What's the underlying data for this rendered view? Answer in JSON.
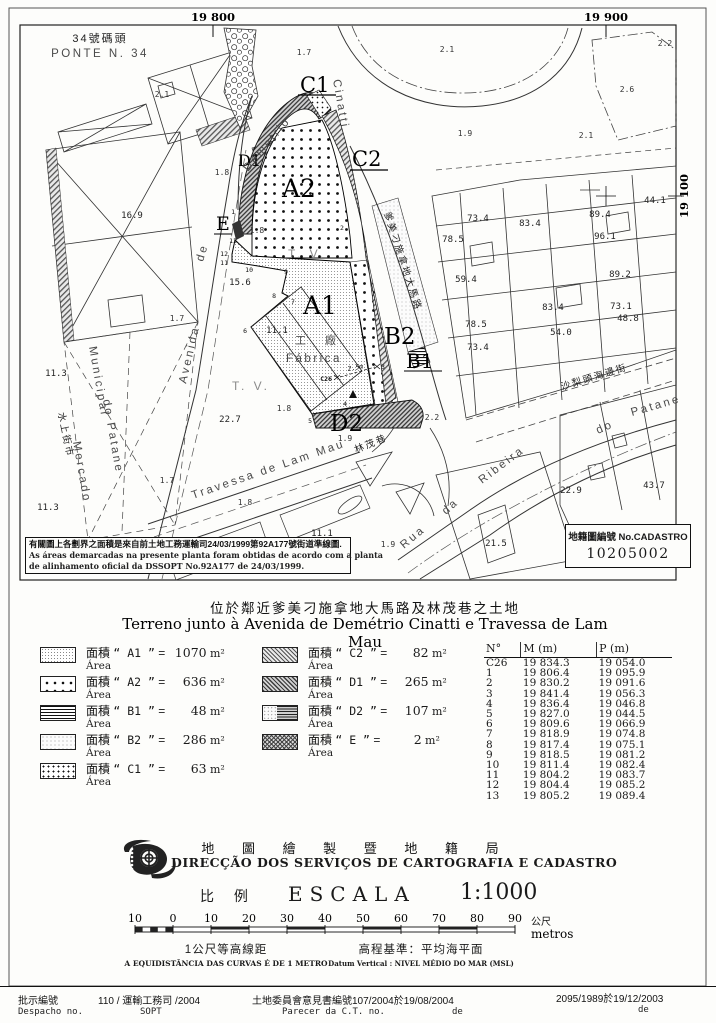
{
  "map": {
    "grid": {
      "top_left": "19 800",
      "top_right": "19 900",
      "right": "19 100"
    },
    "pier_zh": "34號碼頭",
    "pier_pt": "PONTE N. 34",
    "area_labels": {
      "a1": "A1",
      "a2": "A2",
      "b1": "B1",
      "b2": "B2",
      "c1": "C1",
      "c2": "C2",
      "d1": "D1",
      "d2": "D2",
      "e": "E"
    },
    "factory_zh": "工 廠",
    "factory_pt": "Fábrica",
    "tv1": "T. V.",
    "tv2": "T. V.",
    "streets": {
      "avenida": "Avenida",
      "de": "de",
      "demetrio": "Demetrio",
      "cinatti": "Cinatti",
      "cinatti_zh": "爹美刁施拿地大馬路",
      "travessa": "Travessa de Lam Mau",
      "travessa_zh": "林茂巷",
      "rua": "Rua",
      "da": "da",
      "ribeira": "Ribeira",
      "do": "do",
      "patane": "Patane",
      "beira_mar_zh": "沙梨頭海邊街",
      "mercado_zh": "水上街市",
      "mercado_1": "Mercado",
      "mercado_2": "Municipal",
      "mercado_3": "do Patane"
    },
    "point_c26": "C26",
    "c26_note": "2.5m",
    "points": [
      "1",
      "2",
      "3",
      "4",
      "5",
      "6",
      "7",
      "8",
      "9",
      "10",
      "11",
      "12",
      "13"
    ],
    "heights": [
      "73.4",
      "83.4",
      "89.4",
      "96.1",
      "78.5",
      "59.4",
      "89.2",
      "83.4",
      "73.1",
      "48.8",
      "78.5",
      "54.0",
      "73.4",
      "44.1",
      "43.7",
      "22.9",
      "21.5",
      "22.7",
      "11.1",
      "11.1",
      "15.6",
      "16.9",
      "11.3",
      "11.3"
    ],
    "spots": [
      "2.1",
      "1.7",
      "2.1",
      "2.2",
      "2.6",
      "1.9",
      "2.1",
      "1.8",
      "1.8",
      "1.7",
      "1.7",
      "1.8",
      "1.9",
      "2.2",
      "1.8",
      "1.9"
    ],
    "note_zh": "有關圖上各劃界之面積是來自前土地工務運輸司24/03/1999第92A177號街道準線圖.",
    "note_pt_1": "As áreas demarcadas na presente planta foram obtidas de acordo com a planta",
    "note_pt_2": "de alinhamento oficial da DSSOPT No.92A177 de 24/03/1999.",
    "cadastro_label": "地籍圖編號 No.CADASTRO",
    "cadastro_no": "10205002"
  },
  "title": {
    "zh": "位於鄰近爹美刁施拿地大馬路及林茂巷之土地",
    "pt": "Terreno junto à Avenida de Demétrio Cinatti e Travessa de Lam Mau"
  },
  "legend": {
    "area_zh": "面積",
    "area_pt": "Área",
    "eq": "=",
    "items": [
      {
        "code_disp": "“ A1 ”",
        "value": "1070",
        "unit": "m²"
      },
      {
        "code_disp": "“ A2 ”",
        "value": "636",
        "unit": "m²"
      },
      {
        "code_disp": "“ B1 ”",
        "value": "48",
        "unit": "m²"
      },
      {
        "code_disp": "“ B2 ”",
        "value": "286",
        "unit": "m²"
      },
      {
        "code_disp": "“ C1 ”",
        "value": "63",
        "unit": "m²"
      },
      {
        "code_disp": "“ C2 ”",
        "value": "82",
        "unit": "m²"
      },
      {
        "code_disp": "“ D1 ”",
        "value": "265",
        "unit": "m²"
      },
      {
        "code_disp": "“ D2 ”",
        "value": "107",
        "unit": "m²"
      },
      {
        "code_disp": "“ E ”",
        "value": "2",
        "unit": "m²"
      }
    ]
  },
  "table": {
    "headers": [
      "N°",
      "M (m)",
      "P (m)"
    ],
    "rows": [
      [
        "C26",
        "19 834.3",
        "19 054.0"
      ],
      [
        "1",
        "19 806.4",
        "19 095.9"
      ],
      [
        "2",
        "19 830.2",
        "19 091.6"
      ],
      [
        "3",
        "19 841.4",
        "19 056.3"
      ],
      [
        "4",
        "19 836.4",
        "19 046.8"
      ],
      [
        "5",
        "19 827.0",
        "19 044.5"
      ],
      [
        "6",
        "19 809.6",
        "19 066.9"
      ],
      [
        "7",
        "19 818.9",
        "19 074.8"
      ],
      [
        "8",
        "19 817.4",
        "19 075.1"
      ],
      [
        "9",
        "19 818.5",
        "19 081.2"
      ],
      [
        "10",
        "19 811.4",
        "19 082.4"
      ],
      [
        "11",
        "19 804.2",
        "19 083.7"
      ],
      [
        "12",
        "19 804.4",
        "19 085.2"
      ],
      [
        "13",
        "19 805.2",
        "19 089.4"
      ]
    ]
  },
  "agency": {
    "zh": "地 圖 繪 製 暨 地 籍 局",
    "pt": "DIRECÇÃO DOS SERVIÇOS DE CARTOGRAFIA E CADASTRO"
  },
  "scale": {
    "zh": "比 例",
    "word": "ESCALA",
    "ratio": "1:1000",
    "ticks": [
      "10",
      "0",
      "10",
      "20",
      "30",
      "40",
      "50",
      "60",
      "70",
      "80",
      "90"
    ],
    "unit_zh": "公尺",
    "unit_pt": "metros"
  },
  "notes": {
    "contour_zh": "1公尺等高線距",
    "contour_pt": "A EQUIDISTÂNCIA DAS CURVAS É DE 1 METRO",
    "datum_zh": "高程基準：平均海平面",
    "datum_pt": "Datum Vertical : NIVEL MÉDIO DO MAR (MSL)"
  },
  "footer": {
    "despacho_zh": "批示編號",
    "despacho_val": "110  /  運輸工務司  /2004",
    "despacho_pt": "Despacho no.",
    "despacho_org": "SOPT",
    "parecer_zh": "土地委員會意見書編號107/2004於19/08/2004",
    "parecer_pt": "Parecer da C.T. no.",
    "parecer_de": "de",
    "right_val": "2095/1989於19/12/2003",
    "right_de": "de"
  }
}
